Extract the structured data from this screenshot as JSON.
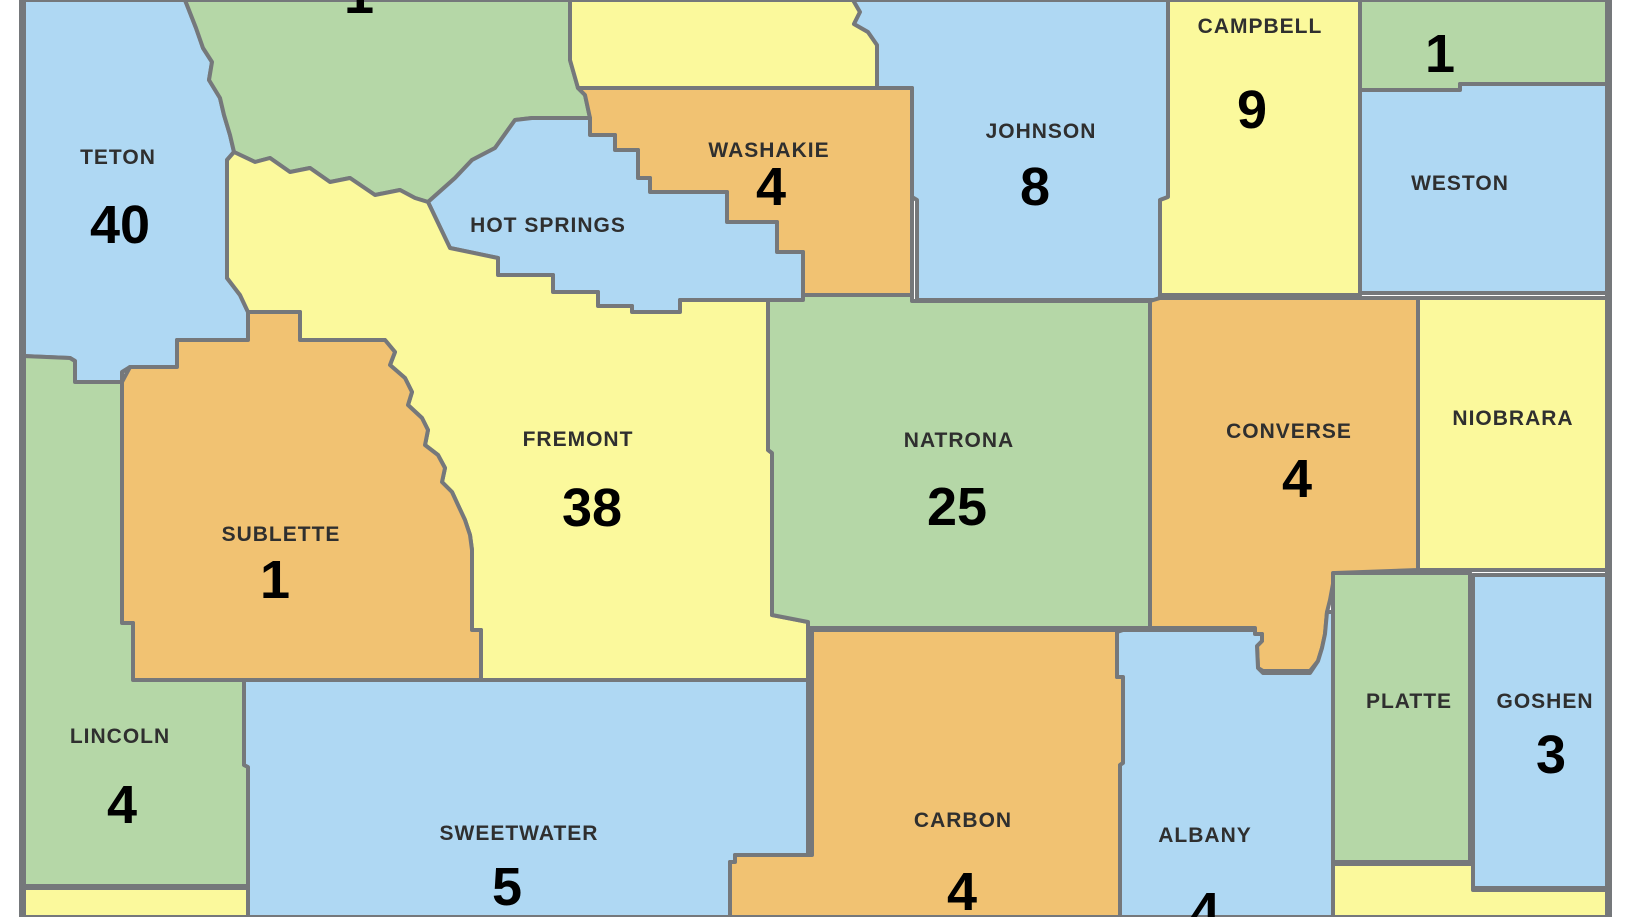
{
  "map": {
    "description": "County map with numeric values per county",
    "border_color": "#75787b",
    "background_color": "#ffffff",
    "palette": {
      "blue": "#afd8f3",
      "green": "#b5d7a7",
      "yellow": "#fbf99c",
      "orange": "#f1c272",
      "label_text": "#2f2f2f",
      "number_text": "#000000"
    },
    "counties": [
      {
        "name": "TETON",
        "value": "40",
        "fill": "#afd8f3"
      },
      {
        "name": "",
        "value": "1",
        "fill": "#b5d7a7",
        "partial": true
      },
      {
        "name": "",
        "value": "",
        "fill": "#fbf99c"
      },
      {
        "name": "JOHNSON",
        "value": "8",
        "fill": "#afd8f3"
      },
      {
        "name": "CAMPBELL",
        "value": "9",
        "fill": "#fbf99c"
      },
      {
        "name": "",
        "value": "1",
        "fill": "#b5d7a7"
      },
      {
        "name": "WESTON",
        "value": "",
        "fill": "#afd8f3"
      },
      {
        "name": "WASHAKIE",
        "value": "4",
        "fill": "#f1c272"
      },
      {
        "name": "HOT SPRINGS",
        "value": "",
        "fill": "#afd8f3"
      },
      {
        "name": "FREMONT",
        "value": "38",
        "fill": "#fbf99c"
      },
      {
        "name": "NATRONA",
        "value": "25",
        "fill": "#b5d7a7"
      },
      {
        "name": "CONVERSE",
        "value": "4",
        "fill": "#f1c272"
      },
      {
        "name": "NIOBRARA",
        "value": "",
        "fill": "#fbf99c"
      },
      {
        "name": "SUBLETTE",
        "value": "1",
        "fill": "#f1c272"
      },
      {
        "name": "LINCOLN",
        "value": "4",
        "fill": "#b5d7a7"
      },
      {
        "name": "SWEETWATER",
        "value": "5",
        "fill": "#afd8f3"
      },
      {
        "name": "CARBON",
        "value": "4",
        "fill": "#f1c272"
      },
      {
        "name": "ALBANY",
        "value": "4",
        "fill": "#afd8f3"
      },
      {
        "name": "PLATTE",
        "value": "",
        "fill": "#b5d7a7"
      },
      {
        "name": "GOSHEN",
        "value": "3",
        "fill": "#afd8f3"
      },
      {
        "name": "",
        "value": "",
        "fill": "#fbf99c"
      },
      {
        "name": "",
        "value": "",
        "fill": "#fbf99c"
      }
    ]
  }
}
